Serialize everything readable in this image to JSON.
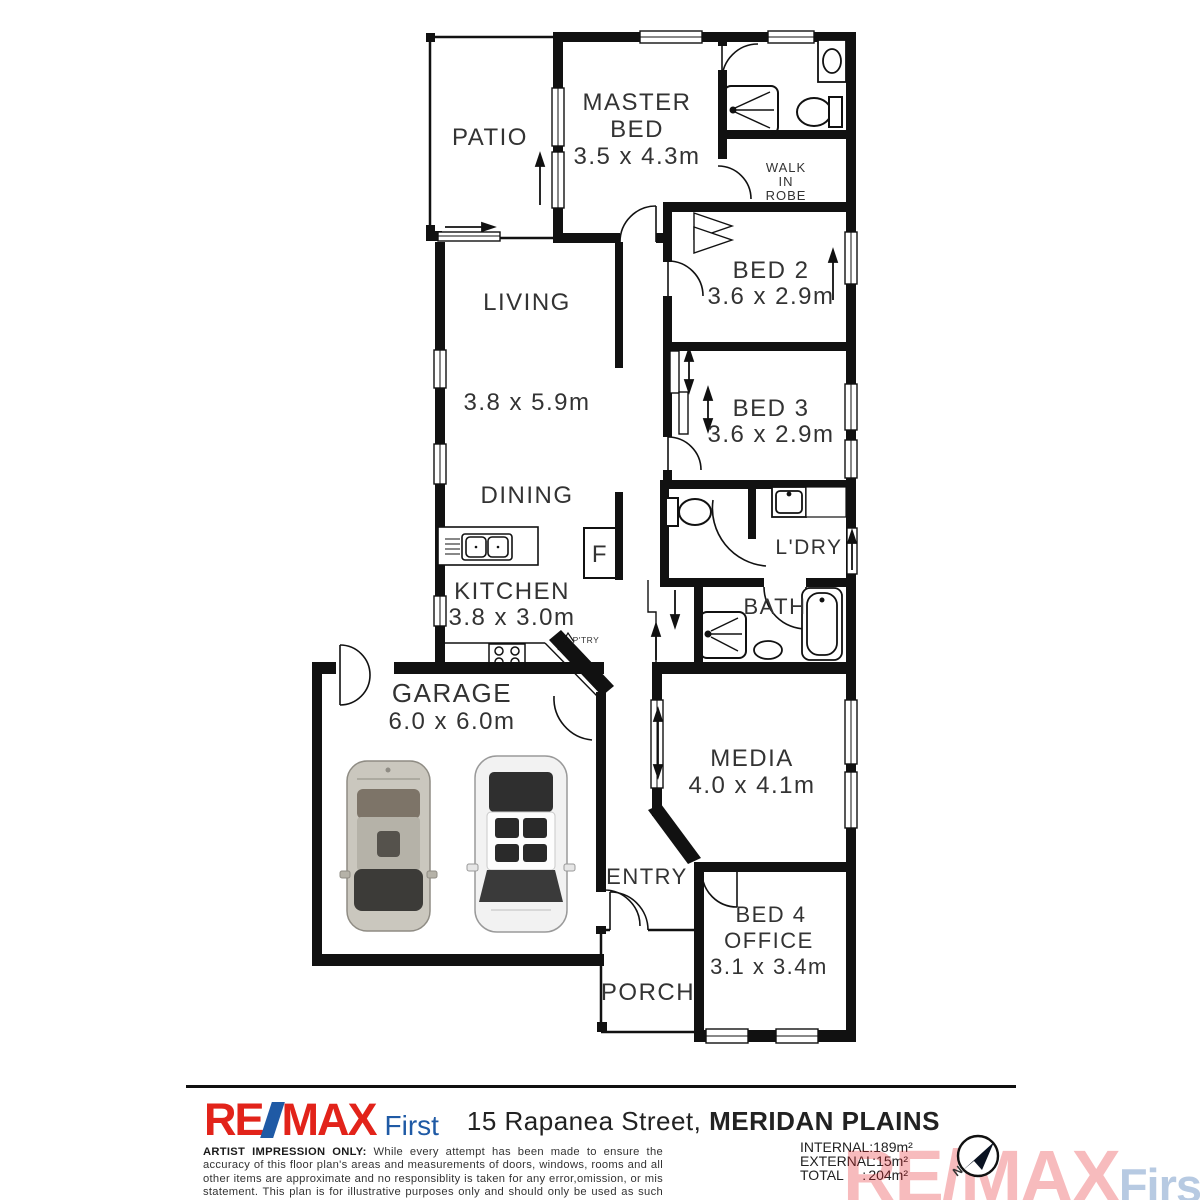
{
  "colors": {
    "wall": "#111111",
    "plan_text": "#333333",
    "remax_red": "#E2231A",
    "remax_blue": "#1F5AA5",
    "watermark_red": "rgba(227,30,36,0.30)",
    "watermark_blue": "rgba(31,90,165,0.32)"
  },
  "rooms": {
    "patio": {
      "name": "PATIO"
    },
    "master": {
      "line1": "MASTER",
      "line2": "BED",
      "dims": "3.5 x 4.3m"
    },
    "wir": {
      "line1": "WALK",
      "line2": "IN",
      "line3": "ROBE"
    },
    "bed2": {
      "name": "BED 2",
      "dims": "3.6 x 2.9m"
    },
    "bed3": {
      "name": "BED 3",
      "dims": "3.6 x 2.9m"
    },
    "living": {
      "name": "LIVING",
      "dims": "3.8 x 5.9m"
    },
    "dining": {
      "name": "DINING"
    },
    "kitchen": {
      "name": "KITCHEN",
      "dims": "3.8 x 3.0m"
    },
    "fridge": {
      "label": "F"
    },
    "pantry": {
      "label": "P'TRY"
    },
    "ldry": {
      "name": "L'DRY"
    },
    "bath": {
      "name": "BATH"
    },
    "garage": {
      "name": "GARAGE",
      "dims": "6.0 x 6.0m"
    },
    "media": {
      "name": "MEDIA",
      "dims": "4.0 x 4.1m"
    },
    "entry": {
      "name": "ENTRY"
    },
    "porch": {
      "name": "PORCH"
    },
    "bed4": {
      "line1": "BED 4",
      "line2": "OFFICE",
      "dims": "3.1 x 3.4m"
    }
  },
  "footer": {
    "logo": {
      "re": "RE",
      "max": "MAX",
      "suffix": "First"
    },
    "address": {
      "street": "15 Rapanea Street, ",
      "suburb": "MERIDAN PLAINS"
    },
    "disclaimer": {
      "lead": "ARTIST IMPRESSION ONLY:",
      "body": " While every attempt has been made to ensure the accuracy of this floor plan's areas and measurements of doors, windows, rooms and all other items are approximate and no responsiblity is taken for any error,omission, or mis statement. This plan is for illustrative purposes only and should only be used as such by any propspective purcharser. ",
      "website": "www.fratterphoto.com"
    },
    "areas": {
      "colon": ":",
      "internal_label": "INTERNAL",
      "internal_value": "189m²",
      "external_label": "EXTERNAL",
      "external_value": "15m²",
      "total_label": "TOTAL",
      "total_value": "204m²"
    },
    "compass": {
      "north": "N"
    },
    "watermark": {
      "remax": "RE/MAX",
      "suffix": "First"
    }
  }
}
